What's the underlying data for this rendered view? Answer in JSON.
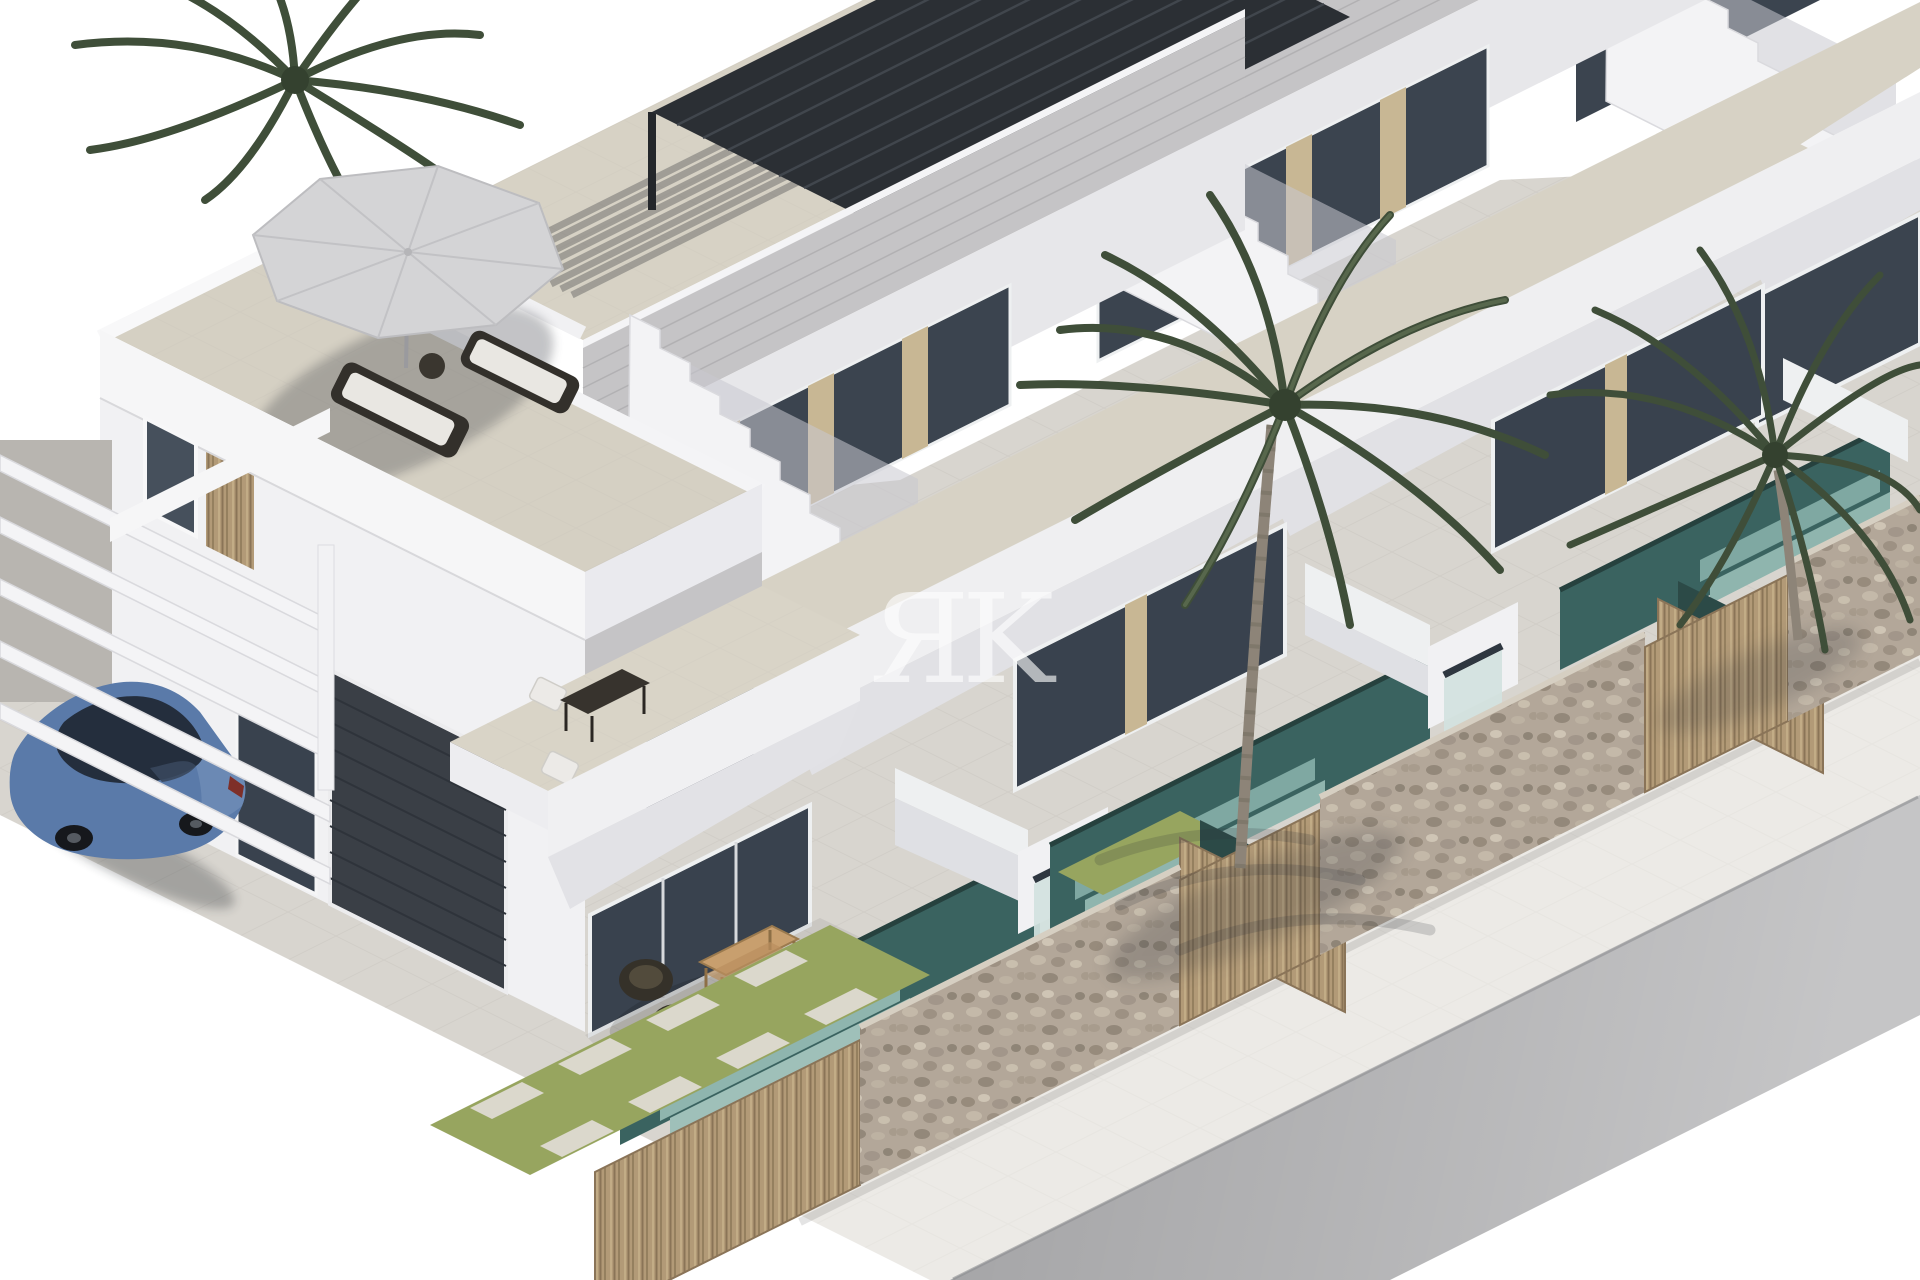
{
  "meta": {
    "type": "3d-architectural-render",
    "title": "New-build villas — isometric exterior render",
    "description": "Isometric 3D architectural rendering of a row of modern white two-storey townhouses with roof terraces, private plunge pools with waterfall features, palm trees, stone and timber boundary walls, a blue sedan parked under a carport pergola, a white sidewalk and a grey asphalt road. White studio background, no text except a watermark."
  },
  "watermark": {
    "text": "ЯK"
  },
  "scene": {
    "villas_visible": 4,
    "palm_trees": 3,
    "objects": [
      "roof terrace with grey parasol and two sun loungers",
      "black louvred pergola on roof terrace",
      "external staircases with stepped white parapets",
      "floor-to-ceiling tinted glazing with beige timber louvres",
      "grey cladding fascia bands",
      "first-floor terrace with dining table and two white chairs",
      "ground-floor patio with wicker chairs and wooden coffee table",
      "dark garage door",
      "carport with white beams",
      "blue sedan car",
      "plunge pools with tiled teal steps",
      "white waterfall water features",
      "natural stone boundary walls",
      "vertical timber slat gates and fences",
      "lawn strips with stepping stones",
      "tiled driveway and yards",
      "white sidewalk",
      "grey road"
    ]
  },
  "palette": {
    "white_wall": "#f2f2f4",
    "shaded_wall": "#e4e4e8",
    "cladding_grey": "#c5c4c6",
    "glass_dark": "#3b444f",
    "louvre_beige": "#c8b794",
    "terrace_tile": "#d7d2c5",
    "pavement": "#d8d5cf",
    "grass_green": "#97a55f",
    "pool_teal": "#3a6360",
    "pool_step": "#7fa8a2",
    "stone_wall": "#b3a799",
    "timber": "#b29a77",
    "pergola_black": "#2b2f34",
    "umbrella_grey": "#d4d4d6",
    "car_blue": "#5a7aa9",
    "road_grey": "#a6a6a8",
    "sidewalk": "#eceae6",
    "palm_green": "#3f4e39",
    "watermark": "#ffffff"
  }
}
